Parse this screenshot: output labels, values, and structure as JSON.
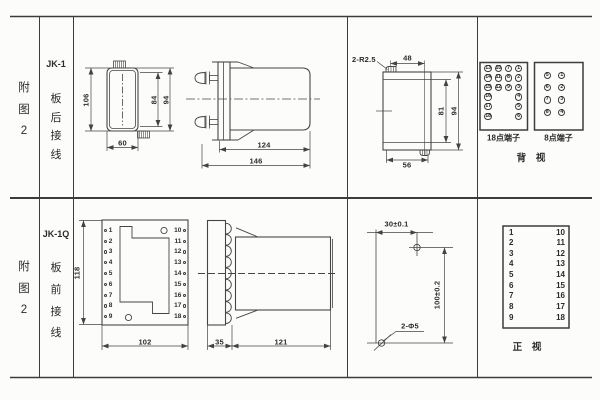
{
  "row1": {
    "figure": [
      "附",
      "图",
      "2"
    ],
    "model": "JK-1",
    "wiring": [
      "板",
      "后",
      "接",
      "线"
    ],
    "front": {
      "h": "106",
      "inner": "84",
      "outer": "94",
      "w": "60"
    },
    "side": {
      "body": "124",
      "total": "146"
    },
    "rear": {
      "fillet": "2-R2.5",
      "top": "48",
      "inner": "81",
      "outer": "94",
      "bottom": "56"
    },
    "term18": {
      "title": "18点端子",
      "rows": [
        [
          "13",
          "10",
          "7",
          "1"
        ],
        [
          "14",
          "11",
          "8",
          "2"
        ],
        [
          "15",
          "12",
          "9",
          "3"
        ],
        [
          "16",
          "",
          "",
          "4"
        ],
        [
          "17",
          "",
          "",
          "5"
        ],
        [
          "18",
          "",
          "",
          "6"
        ]
      ]
    },
    "term8": {
      "title": "8点端子",
      "rows": [
        [
          "5",
          "1"
        ],
        [
          "6",
          "2"
        ],
        [
          "7",
          "3"
        ],
        [
          "8",
          "4"
        ]
      ]
    },
    "caption": "背 视"
  },
  "row2": {
    "figure": [
      "附",
      "图",
      "2"
    ],
    "model": "JK-1Q",
    "wiring": [
      "板",
      "前",
      "接",
      "线"
    ],
    "panel": {
      "left": [
        "1",
        "2",
        "3",
        "4",
        "5",
        "6",
        "7",
        "8",
        "9"
      ],
      "right": [
        "10",
        "11",
        "12",
        "13",
        "14",
        "15",
        "16",
        "17",
        "18"
      ],
      "h": "118",
      "w": "102"
    },
    "side": {
      "plate": "35",
      "body": "121"
    },
    "drill": {
      "h": "30±0.1",
      "v": "100±0.2",
      "holes": "2-Φ5"
    },
    "table": {
      "left": [
        "1",
        "2",
        "3",
        "4",
        "5",
        "6",
        "7",
        "8",
        "9"
      ],
      "right": [
        "10",
        "11",
        "12",
        "13",
        "14",
        "15",
        "16",
        "17",
        "18"
      ]
    },
    "caption": "正 视"
  }
}
